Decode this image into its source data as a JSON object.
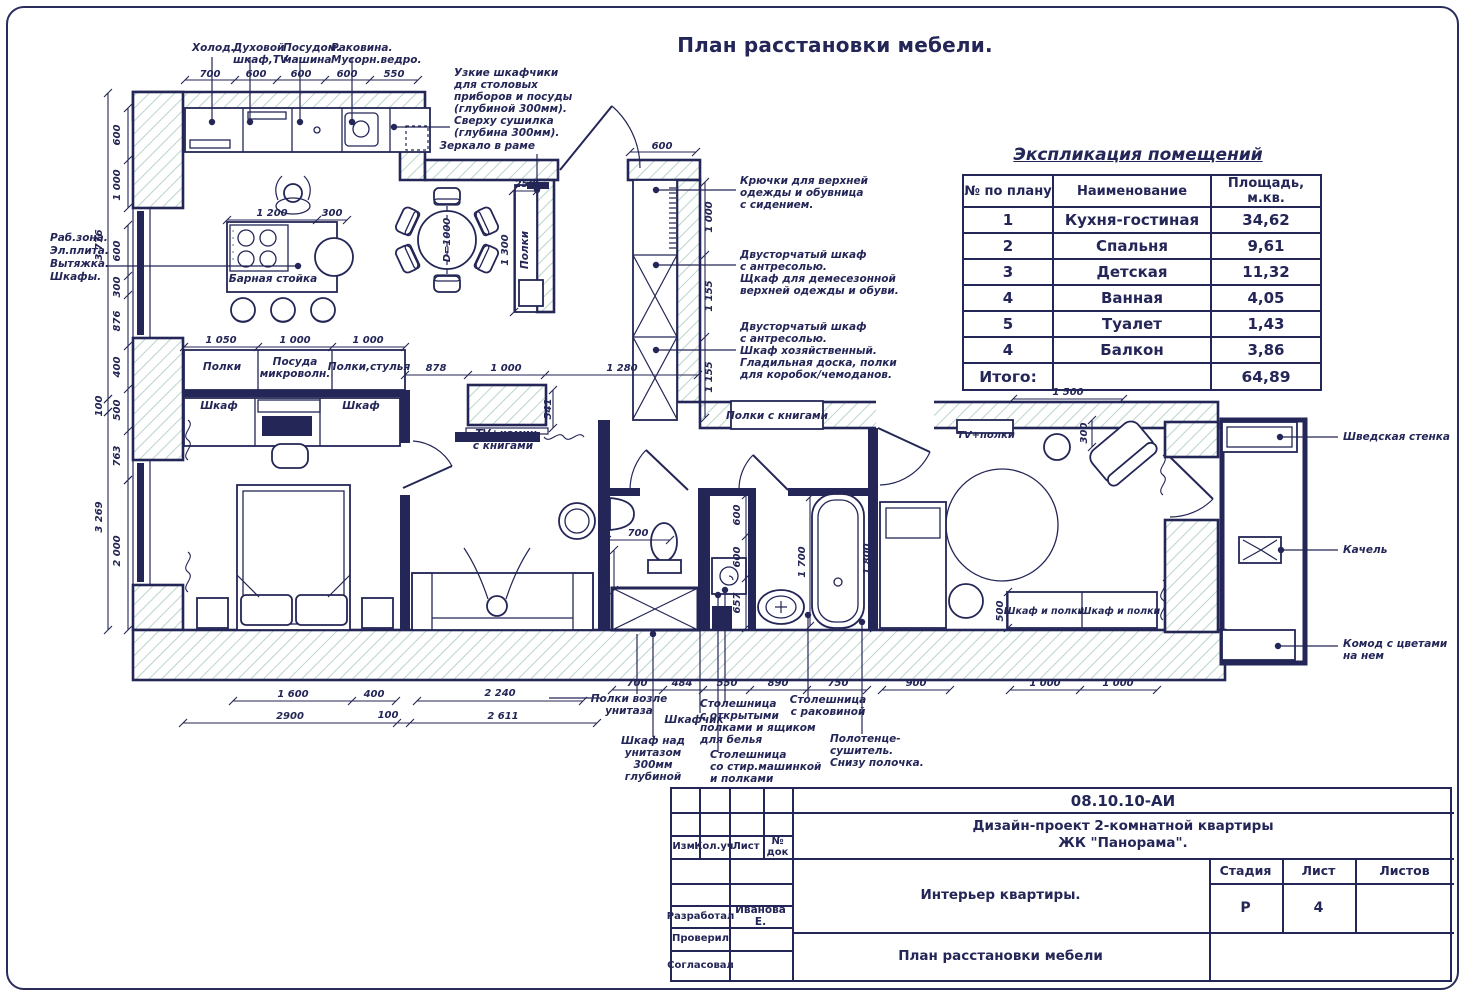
{
  "page_title": "План расстановки мебели.",
  "colors": {
    "ink": "#232656",
    "hatch": "#aecdc1"
  },
  "legend": {
    "title": "Экспликация помещений",
    "headers": [
      "№ по плану",
      "Наименование",
      "Площадь, м.кв."
    ],
    "rows": [
      [
        "1",
        "Кухня-гостиная",
        "34,62"
      ],
      [
        "2",
        "Спальня",
        "9,61"
      ],
      [
        "3",
        "Детская",
        "11,32"
      ],
      [
        "4",
        "Ванная",
        "4,05"
      ],
      [
        "5",
        "Туалет",
        "1,43"
      ],
      [
        "4",
        "Балкон",
        "3,86"
      ]
    ],
    "total_label": "Итого:",
    "total_value": "64,89"
  },
  "titleblock": {
    "doc_code": "08.10.10-АИ",
    "project_line1": "Дизайн-проект 2-комнатной квартиры",
    "project_line2": "ЖК \"Панорама\".",
    "interior_title": "Интерьер квартиры.",
    "sheet_name": "План расстановки мебели",
    "col_izm": "Изм.",
    "col_koluch": "Кол.уч",
    "col_list": "Лист",
    "col_ndok": "№ док",
    "stage_label": "Стадия",
    "sheet_label": "Лист",
    "sheets_label": "Листов",
    "stage_value": "Р",
    "sheet_value": "4",
    "developed_label": "Разработал",
    "developed_value": "Иванова Е.",
    "checked_label": "Проверил",
    "agreed_label": "Согласовал"
  },
  "plan": {
    "texts": [
      {
        "t": "Холод.",
        "x": 192,
        "y": 51,
        "a": "s"
      },
      {
        "t": "Духовой",
        "x": 233,
        "y": 51,
        "a": "s"
      },
      {
        "t": "шкаф,TV",
        "x": 233,
        "y": 63,
        "a": "s"
      },
      {
        "t": "Посудом.",
        "x": 283,
        "y": 51,
        "a": "s"
      },
      {
        "t": "машина",
        "x": 283,
        "y": 63,
        "a": "s"
      },
      {
        "t": "Раковина.",
        "x": 331,
        "y": 51,
        "a": "s"
      },
      {
        "t": "Мусорн.ведро.",
        "x": 331,
        "y": 63,
        "a": "s"
      },
      {
        "t": "Узкие шкафчики",
        "x": 454,
        "y": 76,
        "a": "s"
      },
      {
        "t": "для столовых",
        "x": 454,
        "y": 88,
        "a": "s"
      },
      {
        "t": "приборов и посуды",
        "x": 454,
        "y": 100,
        "a": "s"
      },
      {
        "t": "(глубиной 300мм).",
        "x": 454,
        "y": 112,
        "a": "s"
      },
      {
        "t": "Сверху сушилка",
        "x": 454,
        "y": 124,
        "a": "s"
      },
      {
        "t": "(глубина 300мм).",
        "x": 454,
        "y": 136,
        "a": "s"
      },
      {
        "t": "Зеркало в раме",
        "x": 535,
        "y": 149,
        "a": "e"
      },
      {
        "t": "Раб.зона.",
        "x": 50,
        "y": 241,
        "a": "s"
      },
      {
        "t": "Эл.плита.",
        "x": 50,
        "y": 254,
        "a": "s"
      },
      {
        "t": "Вытяжка.",
        "x": 50,
        "y": 267,
        "a": "s"
      },
      {
        "t": "Шкафы.",
        "x": 50,
        "y": 280,
        "a": "s"
      },
      {
        "t": "Крючки для верхней",
        "x": 740,
        "y": 184,
        "a": "s"
      },
      {
        "t": "одежды и обувница",
        "x": 740,
        "y": 196,
        "a": "s"
      },
      {
        "t": "с сидением.",
        "x": 740,
        "y": 208,
        "a": "s"
      },
      {
        "t": "Двусторчатый шкаф",
        "x": 740,
        "y": 258,
        "a": "s"
      },
      {
        "t": "с антресолью.",
        "x": 740,
        "y": 270,
        "a": "s"
      },
      {
        "t": "Щкаф для демесезонной",
        "x": 740,
        "y": 282,
        "a": "s"
      },
      {
        "t": "верхней одежды и обуви.",
        "x": 740,
        "y": 294,
        "a": "s"
      },
      {
        "t": "Двусторчатый шкаф",
        "x": 740,
        "y": 330,
        "a": "s"
      },
      {
        "t": "с антресолью.",
        "x": 740,
        "y": 342,
        "a": "s"
      },
      {
        "t": "Шкаф хозяйственный.",
        "x": 740,
        "y": 354,
        "a": "s"
      },
      {
        "t": "Гладильная доска, полки",
        "x": 740,
        "y": 366,
        "a": "s"
      },
      {
        "t": "для коробок/чемоданов.",
        "x": 740,
        "y": 378,
        "a": "s"
      },
      {
        "t": "Полки с книгами",
        "x": 777,
        "y": 419
      },
      {
        "t": "TV+полки",
        "x": 986,
        "y": 438,
        "s": 10
      },
      {
        "t": "TV+камин",
        "x": 506,
        "y": 437
      },
      {
        "t": "с книгами",
        "x": 503,
        "y": 449
      },
      {
        "t": "Шведская стенка",
        "x": 1343,
        "y": 440,
        "a": "s"
      },
      {
        "t": "Качель",
        "x": 1343,
        "y": 553,
        "a": "s"
      },
      {
        "t": "Комод с цветами",
        "x": 1343,
        "y": 647,
        "a": "s"
      },
      {
        "t": "на нем",
        "x": 1343,
        "y": 659,
        "a": "s"
      },
      {
        "t": "Шкаф и полки",
        "x": 1044,
        "y": 614,
        "s": 9.5
      },
      {
        "t": "Шкаф и полки",
        "x": 1120,
        "y": 614,
        "s": 9.5
      },
      {
        "t": "Барная стойка",
        "x": 273,
        "y": 282
      },
      {
        "t": "Полки",
        "x": 222,
        "y": 370
      },
      {
        "t": "Посуда",
        "x": 295,
        "y": 365
      },
      {
        "t": "микроволн.",
        "x": 295,
        "y": 377
      },
      {
        "t": "Полки,стулья",
        "x": 369,
        "y": 370
      },
      {
        "t": "Шкаф",
        "x": 219,
        "y": 409
      },
      {
        "t": "Шкаф",
        "x": 361,
        "y": 409
      },
      {
        "t": "Полки",
        "x": 528,
        "y": 250,
        "r": 1
      },
      {
        "t": "D=1000",
        "x": 450,
        "y": 240,
        "r": 1,
        "s": 10
      },
      {
        "t": "Полки возле",
        "x": 629,
        "y": 702
      },
      {
        "t": "унитаза",
        "x": 629,
        "y": 714
      },
      {
        "t": "Шкафчик",
        "x": 694,
        "y": 723
      },
      {
        "t": "Столешница",
        "x": 700,
        "y": 707,
        "a": "s"
      },
      {
        "t": "с открытыми",
        "x": 700,
        "y": 719,
        "a": "s"
      },
      {
        "t": "полками и ящиком",
        "x": 700,
        "y": 731,
        "a": "s"
      },
      {
        "t": "для белья",
        "x": 700,
        "y": 743,
        "a": "s"
      },
      {
        "t": "Столешница",
        "x": 828,
        "y": 703
      },
      {
        "t": "с раковиной",
        "x": 828,
        "y": 715
      },
      {
        "t": "Шкаф над",
        "x": 653,
        "y": 744
      },
      {
        "t": "унитазом",
        "x": 653,
        "y": 756
      },
      {
        "t": "300мм",
        "x": 653,
        "y": 768
      },
      {
        "t": "глубиной",
        "x": 653,
        "y": 780
      },
      {
        "t": "Столешница",
        "x": 710,
        "y": 758,
        "a": "s"
      },
      {
        "t": "со стир.машинкой",
        "x": 710,
        "y": 770,
        "a": "s"
      },
      {
        "t": "и полками",
        "x": 710,
        "y": 782,
        "a": "s"
      },
      {
        "t": "Полотенце-",
        "x": 830,
        "y": 742,
        "a": "s"
      },
      {
        "t": "сушитель.",
        "x": 830,
        "y": 754,
        "a": "s"
      },
      {
        "t": "Снизу полочка.",
        "x": 830,
        "y": 766,
        "a": "s"
      },
      {
        "t": "700",
        "x": 210,
        "y": 77,
        "s": 10
      },
      {
        "t": "600",
        "x": 256,
        "y": 77,
        "s": 10
      },
      {
        "t": "600",
        "x": 301,
        "y": 77,
        "s": 10
      },
      {
        "t": "600",
        "x": 347,
        "y": 77,
        "s": 10
      },
      {
        "t": "550",
        "x": 394,
        "y": 77,
        "s": 10
      },
      {
        "t": "600",
        "x": 662,
        "y": 149,
        "s": 10
      },
      {
        "t": "1 200",
        "x": 272,
        "y": 216,
        "s": 10
      },
      {
        "t": "300",
        "x": 332,
        "y": 216,
        "s": 10
      },
      {
        "t": "250",
        "x": 525,
        "y": 187,
        "s": 10
      },
      {
        "t": "1 050",
        "x": 221,
        "y": 343,
        "s": 10
      },
      {
        "t": "1 000",
        "x": 295,
        "y": 343,
        "s": 10
      },
      {
        "t": "1 000",
        "x": 368,
        "y": 343,
        "s": 10
      },
      {
        "t": "878",
        "x": 436,
        "y": 371,
        "s": 10
      },
      {
        "t": "1 000",
        "x": 506,
        "y": 371,
        "s": 10
      },
      {
        "t": "1 280",
        "x": 622,
        "y": 371,
        "s": 10
      },
      {
        "t": "1 500",
        "x": 1068,
        "y": 395,
        "s": 10
      },
      {
        "t": "700",
        "x": 638,
        "y": 536,
        "s": 10
      },
      {
        "t": "700",
        "x": 637,
        "y": 686,
        "s": 10
      },
      {
        "t": "484",
        "x": 682,
        "y": 686,
        "s": 10
      },
      {
        "t": "550",
        "x": 727,
        "y": 686,
        "s": 10
      },
      {
        "t": "890",
        "x": 778,
        "y": 686,
        "s": 10
      },
      {
        "t": "750",
        "x": 838,
        "y": 686,
        "s": 10
      },
      {
        "t": "900",
        "x": 916,
        "y": 686,
        "s": 10
      },
      {
        "t": "1 000",
        "x": 1045,
        "y": 686,
        "s": 10
      },
      {
        "t": "1 000",
        "x": 1118,
        "y": 686,
        "s": 10
      },
      {
        "t": "1 600",
        "x": 293,
        "y": 697,
        "s": 10
      },
      {
        "t": "400",
        "x": 374,
        "y": 697,
        "s": 10
      },
      {
        "t": "2 240",
        "x": 500,
        "y": 696,
        "s": 10
      },
      {
        "t": "2900",
        "x": 290,
        "y": 719,
        "s": 10
      },
      {
        "t": "100",
        "x": 388,
        "y": 718,
        "s": 10
      },
      {
        "t": "2 611",
        "x": 503,
        "y": 719,
        "s": 10
      },
      {
        "t": "600",
        "x": 120,
        "y": 135,
        "r": 1,
        "s": 10
      },
      {
        "t": "1 000",
        "x": 120,
        "y": 185,
        "r": 1,
        "s": 10
      },
      {
        "t": "600",
        "x": 120,
        "y": 251,
        "r": 1,
        "s": 10
      },
      {
        "t": "300",
        "x": 120,
        "y": 287,
        "r": 1,
        "s": 10
      },
      {
        "t": "876",
        "x": 120,
        "y": 321,
        "r": 1,
        "s": 10
      },
      {
        "t": "400",
        "x": 120,
        "y": 367,
        "r": 1,
        "s": 10
      },
      {
        "t": "500",
        "x": 120,
        "y": 410,
        "r": 1,
        "s": 10
      },
      {
        "t": "763",
        "x": 120,
        "y": 456,
        "r": 1,
        "s": 10
      },
      {
        "t": "2 000",
        "x": 120,
        "y": 551,
        "r": 1,
        "s": 10
      },
      {
        "t": "3 776",
        "x": 102,
        "y": 245,
        "r": 1,
        "s": 10
      },
      {
        "t": "100",
        "x": 102,
        "y": 406,
        "r": 1,
        "s": 10
      },
      {
        "t": "3 269",
        "x": 102,
        "y": 517,
        "r": 1,
        "s": 10
      },
      {
        "t": "1 000",
        "x": 712,
        "y": 217,
        "r": 1,
        "s": 10
      },
      {
        "t": "1 155",
        "x": 712,
        "y": 296,
        "r": 1,
        "s": 10
      },
      {
        "t": "1 155",
        "x": 712,
        "y": 377,
        "r": 1,
        "s": 10
      },
      {
        "t": "1 300",
        "x": 508,
        "y": 250,
        "r": 1,
        "s": 10
      },
      {
        "t": "541",
        "x": 551,
        "y": 409,
        "r": 1,
        "s": 10
      },
      {
        "t": "300",
        "x": 608,
        "y": 571,
        "r": 1,
        "s": 10
      },
      {
        "t": "600",
        "x": 740,
        "y": 515,
        "r": 1,
        "s": 10
      },
      {
        "t": "600",
        "x": 740,
        "y": 557,
        "r": 1,
        "s": 10
      },
      {
        "t": "657",
        "x": 740,
        "y": 603,
        "r": 1,
        "s": 10
      },
      {
        "t": "1 700",
        "x": 805,
        "y": 562,
        "r": 1,
        "s": 10
      },
      {
        "t": "1 800",
        "x": 870,
        "y": 559,
        "r": 1,
        "s": 10
      },
      {
        "t": "300",
        "x": 1087,
        "y": 433,
        "r": 1,
        "s": 10
      },
      {
        "t": "500",
        "x": 1003,
        "y": 611,
        "r": 1,
        "s": 10
      }
    ],
    "hdims": [
      {
        "y": 80,
        "xs": [
          185,
          235,
          277,
          325,
          370,
          418
        ]
      },
      {
        "y": 152,
        "xs": [
          630,
          696
        ]
      },
      {
        "y": 220,
        "xs": [
          227,
          317,
          347
        ]
      },
      {
        "y": 191,
        "xs": [
          513,
          537
        ]
      },
      {
        "y": 347,
        "xs": [
          184,
          258,
          332,
          405
        ]
      },
      {
        "y": 375,
        "xs": [
          405,
          468,
          545,
          698
        ]
      },
      {
        "y": 399,
        "xs": [
          1013,
          1123
        ]
      },
      {
        "y": 540,
        "xs": [
          607,
          670
        ]
      },
      {
        "y": 690,
        "xs": [
          612,
          663,
          703,
          750,
          807,
          867
        ]
      },
      {
        "y": 690,
        "xs": [
          882,
          950
        ]
      },
      {
        "y": 690,
        "xs": [
          1010,
          1080,
          1157
        ]
      },
      {
        "y": 701,
        "xs": [
          233,
          352,
          396
        ]
      },
      {
        "y": 701,
        "xs": [
          417,
          583
        ]
      },
      {
        "y": 723,
        "xs": [
          183,
          397,
          410,
          597
        ]
      }
    ],
    "vdims": [
      {
        "x": 128,
        "ys": [
          108,
          160,
          208
        ]
      },
      {
        "x": 128,
        "ys": [
          225,
          276,
          295,
          346,
          389,
          431,
          480
        ]
      },
      {
        "x": 128,
        "ys": [
          480,
          630
        ]
      },
      {
        "x": 108,
        "ys": [
          93,
          399
        ]
      },
      {
        "x": 108,
        "ys": [
          399,
          412
        ]
      },
      {
        "x": 108,
        "ys": [
          412,
          630
        ]
      },
      {
        "x": 705,
        "ys": [
          182,
          255,
          337,
          418
        ]
      },
      {
        "x": 514,
        "ys": [
          190,
          312
        ]
      },
      {
        "x": 553,
        "ys": [
          390,
          428
        ]
      },
      {
        "x": 614,
        "ys": [
          550,
          590
        ]
      },
      {
        "x": 746,
        "ys": [
          495,
          536,
          578,
          628
        ]
      },
      {
        "x": 810,
        "ys": [
          497,
          626
        ]
      },
      {
        "x": 874,
        "ys": [
          490,
          628
        ]
      },
      {
        "x": 1092,
        "ys": [
          420,
          447
        ]
      },
      {
        "x": 1008,
        "ys": [
          592,
          628
        ]
      }
    ],
    "leaders": [
      {
        "p": [
          [
            212,
            122
          ],
          [
            212,
            57
          ]
        ],
        "d": 1
      },
      {
        "p": [
          [
            250,
            122
          ],
          [
            250,
            57
          ]
        ],
        "d": 1
      },
      {
        "p": [
          [
            300,
            122
          ],
          [
            300,
            57
          ]
        ],
        "d": 1
      },
      {
        "p": [
          [
            352,
            122
          ],
          [
            352,
            57
          ]
        ],
        "d": 1
      },
      {
        "p": [
          [
            394,
            127
          ],
          [
            450,
            127
          ]
        ],
        "d": 1
      },
      {
        "p": [
          [
            537,
            190
          ],
          [
            537,
            154
          ]
        ],
        "d": 1
      },
      {
        "p": [
          [
            298,
            266
          ],
          [
            107,
            266
          ]
        ],
        "d": 1
      },
      {
        "p": [
          [
            656,
            190
          ],
          [
            736,
            190
          ]
        ],
        "d": 1
      },
      {
        "p": [
          [
            656,
            265
          ],
          [
            736,
            265
          ]
        ],
        "d": 1
      },
      {
        "p": [
          [
            656,
            350
          ],
          [
            736,
            350
          ]
        ],
        "d": 1
      },
      {
        "p": [
          [
            1280,
            437
          ],
          [
            1338,
            437
          ]
        ],
        "d": 1
      },
      {
        "p": [
          [
            1281,
            550
          ],
          [
            1338,
            550
          ]
        ],
        "d": 1
      },
      {
        "p": [
          [
            1278,
            646
          ],
          [
            1338,
            646
          ]
        ],
        "d": 1
      },
      {
        "p": [
          [
            637,
            634
          ],
          [
            637,
            694
          ]
        ]
      },
      {
        "p": [
          [
            653,
            634
          ],
          [
            653,
            737
          ]
        ],
        "d": 1
      },
      {
        "p": [
          [
            700,
            608
          ],
          [
            700,
            713
          ]
        ],
        "d": 1
      },
      {
        "p": [
          [
            725,
            590
          ],
          [
            725,
            701
          ]
        ],
        "d": 1
      },
      {
        "p": [
          [
            808,
            615
          ],
          [
            808,
            697
          ]
        ],
        "d": 1
      },
      {
        "p": [
          [
            718,
            595
          ],
          [
            718,
            752
          ]
        ],
        "d": 1
      },
      {
        "p": [
          [
            862,
            622
          ],
          [
            862,
            734
          ]
        ],
        "d": 1
      },
      {
        "p": [
          [
            600,
            698
          ],
          [
            549,
            698
          ]
        ]
      }
    ]
  }
}
